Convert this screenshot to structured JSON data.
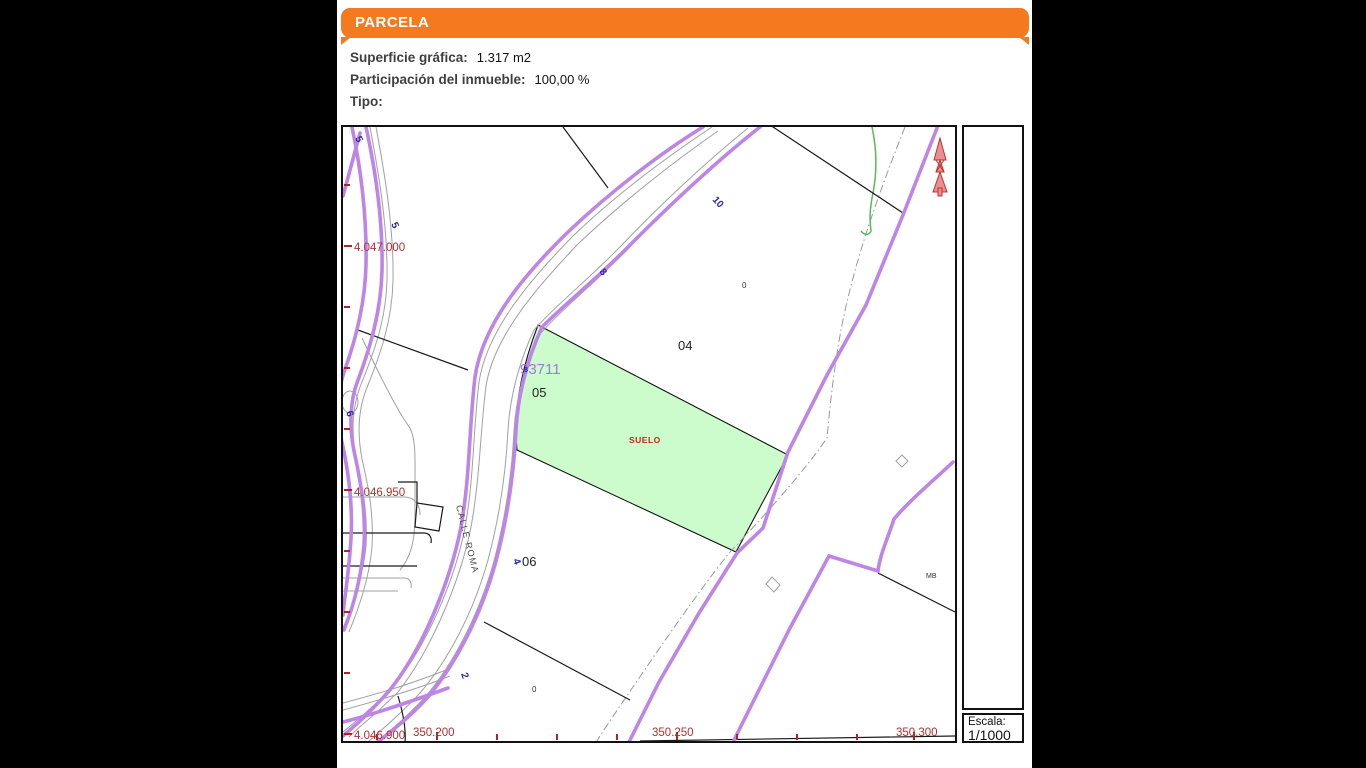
{
  "header": {
    "title": "PARCELA",
    "color": "#F4791F"
  },
  "info": {
    "rows": [
      {
        "label": "Superficie gráfica:",
        "value": "1.317 m2"
      },
      {
        "label": "Participación del inmueble:",
        "value": "100,00 %"
      },
      {
        "label": "Tipo:",
        "value": ""
      }
    ]
  },
  "map": {
    "coords_left": [
      "4.047.000",
      "4.046.950",
      "4.046.900"
    ],
    "coords_bottom": [
      "350.200",
      "350.250",
      "350.300"
    ],
    "parcel_labels": [
      "04",
      "05",
      "06"
    ],
    "zero_labels": [
      "0",
      "0"
    ],
    "mb_label": "MB",
    "manzana_number": "93711",
    "suelo_label": "SUELO",
    "street_name": "CALLE ROMA",
    "street_numbers": [
      "5",
      "5",
      "6",
      "8",
      "10",
      "4",
      "2",
      "8"
    ],
    "colors": {
      "manzana_purple": "#BE84E8",
      "parcel_green_fill": "#CCFCCC",
      "coord_red": "#B03030",
      "street_blue": "#2929A3",
      "suelo_red": "#CC2020",
      "manzana_number_purple": "#9C7BD9"
    }
  },
  "legend": {
    "row1": [
      {
        "label": "Límite de manzana"
      },
      {
        "label": "Límite de parcela"
      },
      {
        "label": "Hidrografía"
      }
    ],
    "row2": [
      {
        "label": "Límite de construcciones"
      },
      {
        "label": "Mobiliario y aceras"
      },
      {
        "label": "Límite zona verde"
      }
    ],
    "coordinates_note": "350.300 Coordenadas U.T.M. Huso 30 ETRS89",
    "disclaimer": "Este documento electrónico contiene anexos con las coordenadas de los vértices UTM de la parcela y los datos de la certificación"
  },
  "scale": {
    "label": "Escala:",
    "value": "1/1000"
  }
}
